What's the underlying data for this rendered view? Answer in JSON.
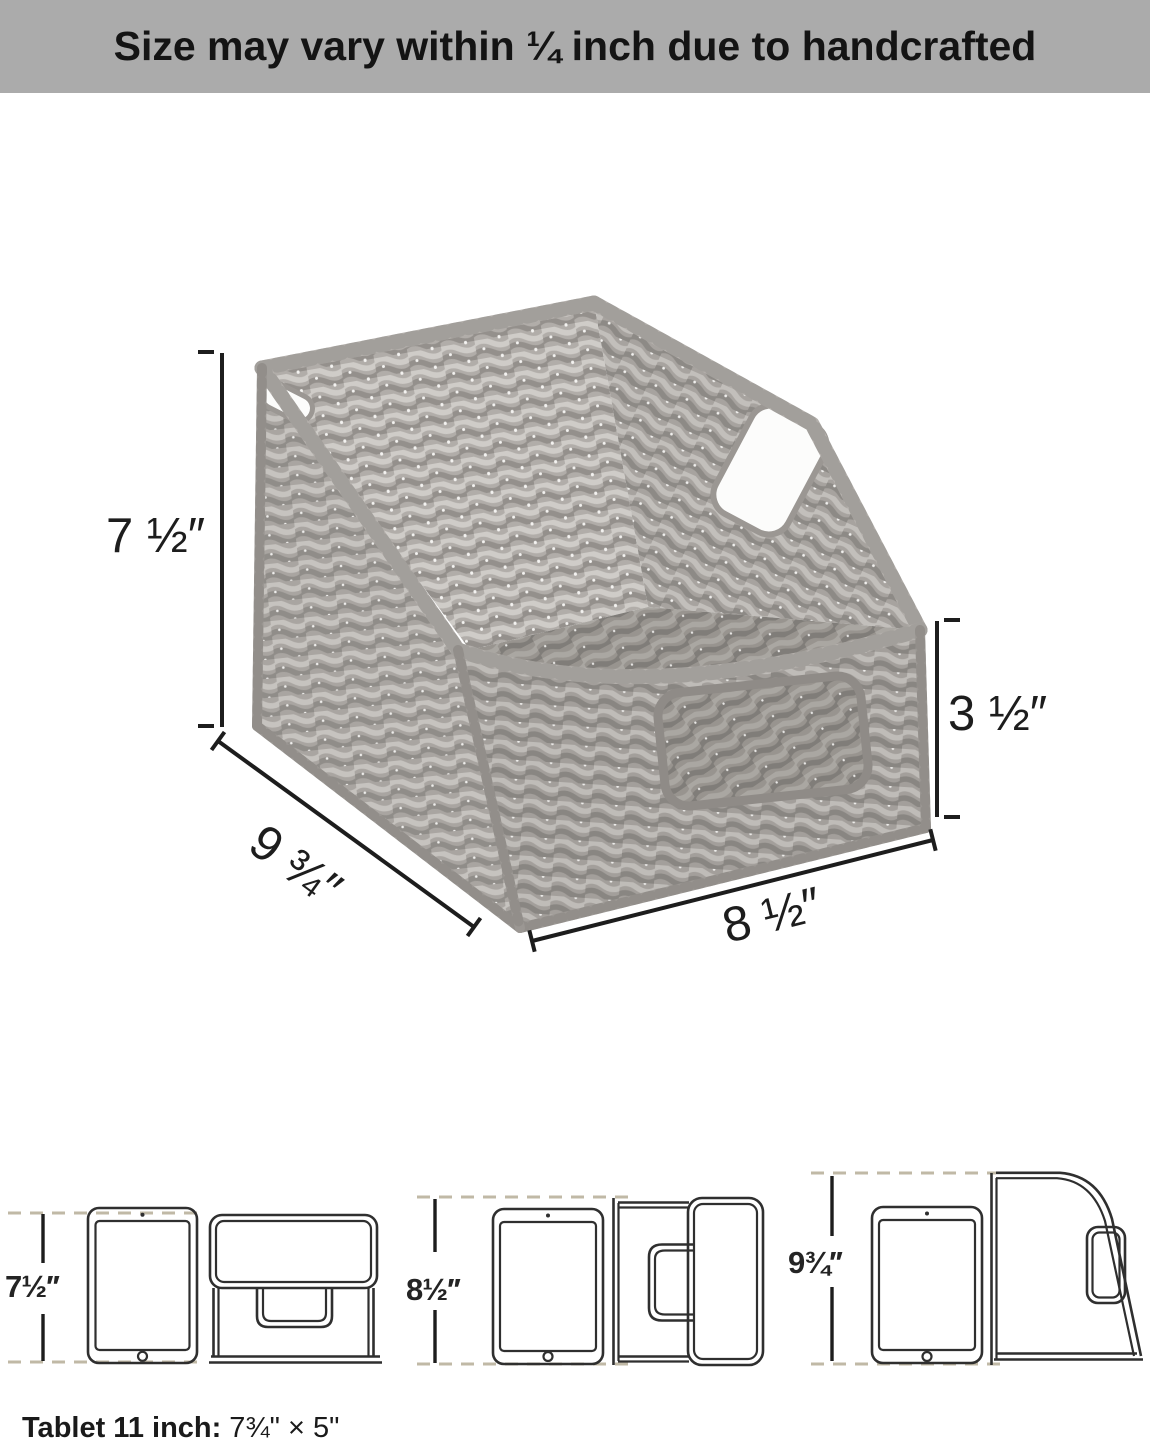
{
  "banner": {
    "text": "Size may vary within ¼ inch due to handcrafted"
  },
  "basket_dimensions": {
    "back_height": "7 ½″",
    "front_height": "3 ½″",
    "side_depth": "9 ¾″",
    "front_width": "8 ½″"
  },
  "fit_diagrams": [
    {
      "view": "tablet-with-basket-front",
      "height": "7½′′"
    },
    {
      "view": "tablet-with-basket-top",
      "height": "8½′′"
    },
    {
      "view": "tablet-with-basket-side",
      "height": "9¾′′"
    }
  ],
  "caption": {
    "label": "Tablet 11 inch:",
    "value": "7¾\" × 5\""
  },
  "colors": {
    "banner_bg": "#ababab",
    "ink": "#1d1d1d",
    "guide_dash": "#c0b9a6",
    "line_art": "#2f2f2f",
    "basket_base": "#a5a19d",
    "basket_light": "#c4c1bd",
    "basket_dark": "#8b8884"
  }
}
